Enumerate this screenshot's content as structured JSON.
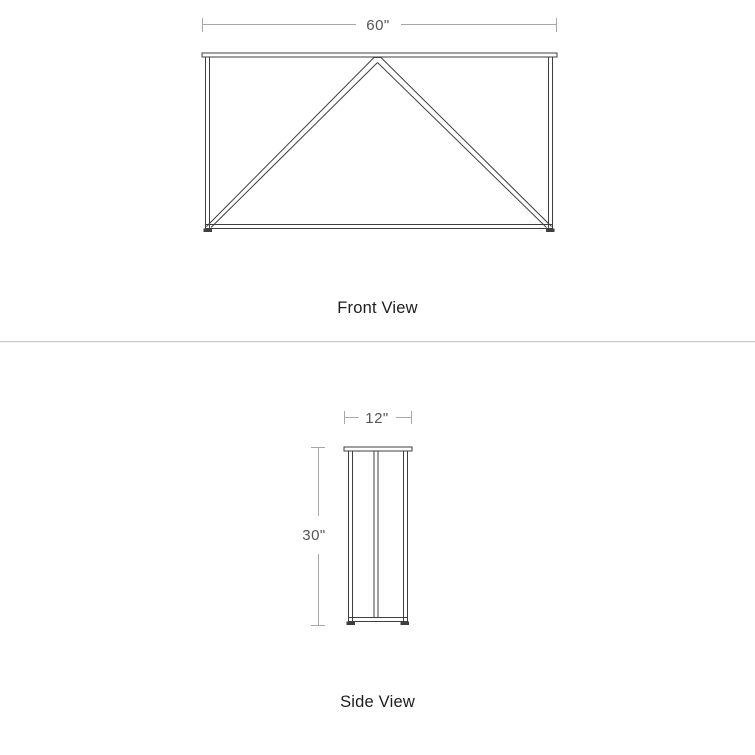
{
  "front_view": {
    "label": "Front View",
    "width_dimension": "60\""
  },
  "side_view": {
    "label": "Side View",
    "width_dimension": "12\"",
    "height_dimension": "30\""
  },
  "colors": {
    "drawing-line": "#3f3f3f",
    "dim-line": "#a7a7a8",
    "dim-text": "#555557",
    "label-text": "#1d1d1f",
    "divider": "#c9cacb",
    "background": "#ffffff"
  }
}
